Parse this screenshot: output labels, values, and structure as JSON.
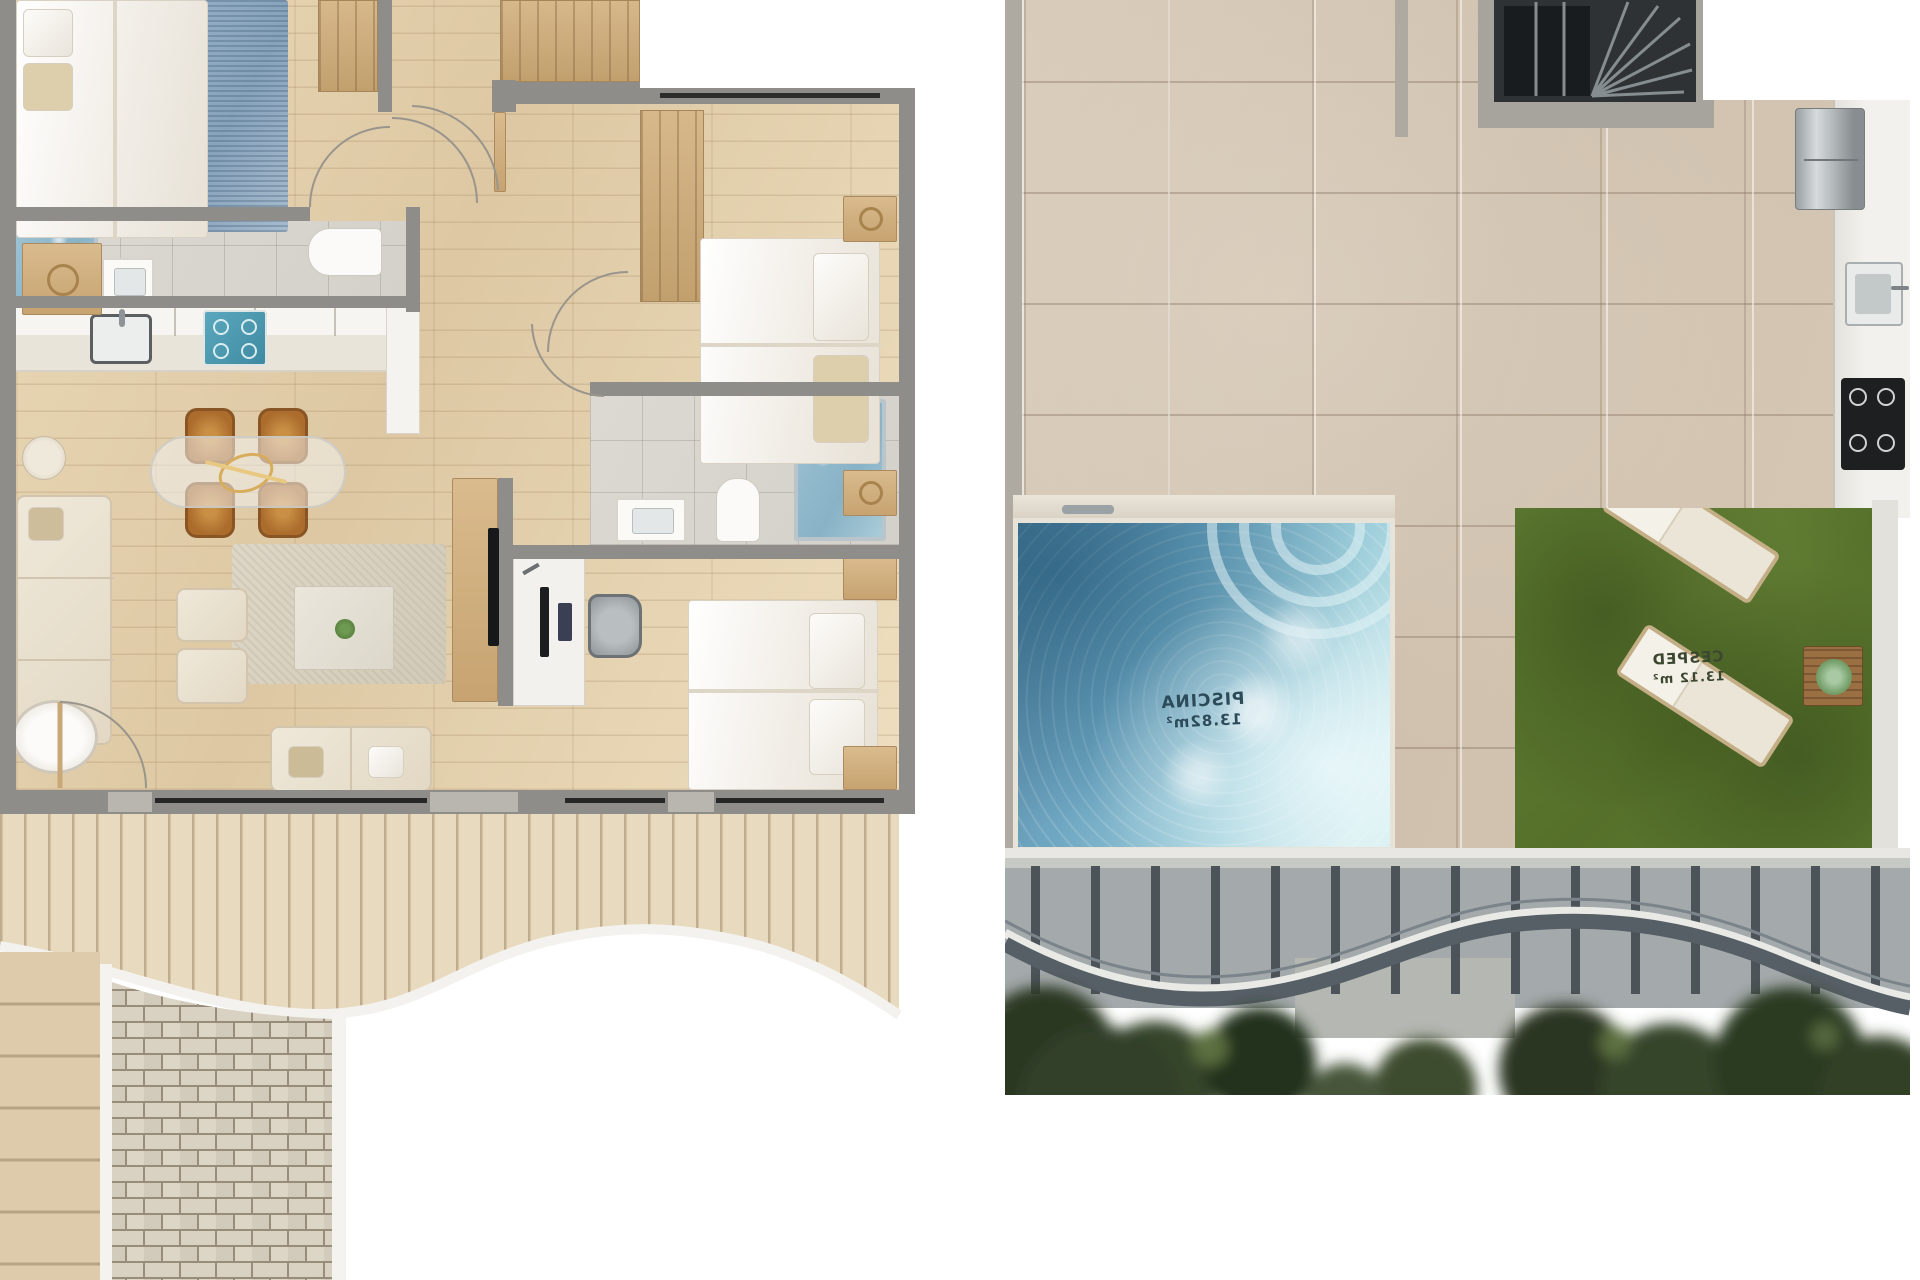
{
  "page": {
    "background": "#ffffff",
    "kind": "architectural-floor-plans"
  },
  "rooftop_plan": {
    "pool": {
      "label": "PISCINA",
      "area": "13.82m²",
      "text_color": "#2c4a58",
      "mirrored": true
    },
    "lawn": {
      "label": "CESPED",
      "area": "13.12 m²",
      "text_color": "#3c4731",
      "mirrored": true
    }
  },
  "palette": {
    "wall_dark": "#8e8d89",
    "wall_light": "#aeaaa2",
    "wood_floor": "#e2cfab",
    "bath_tile": "#d8d4ce",
    "terrace_tile": "#d3c5b3",
    "deck": "#e7d9bf",
    "pool_deep": "#55809c",
    "pool_shallow": "#cfeaec",
    "grass": "#5a782f",
    "trees": "#2f3b25",
    "railing": "#565e64",
    "accent_chair": "#ab6c2c",
    "cooktop_teal": "#4f9db4"
  }
}
